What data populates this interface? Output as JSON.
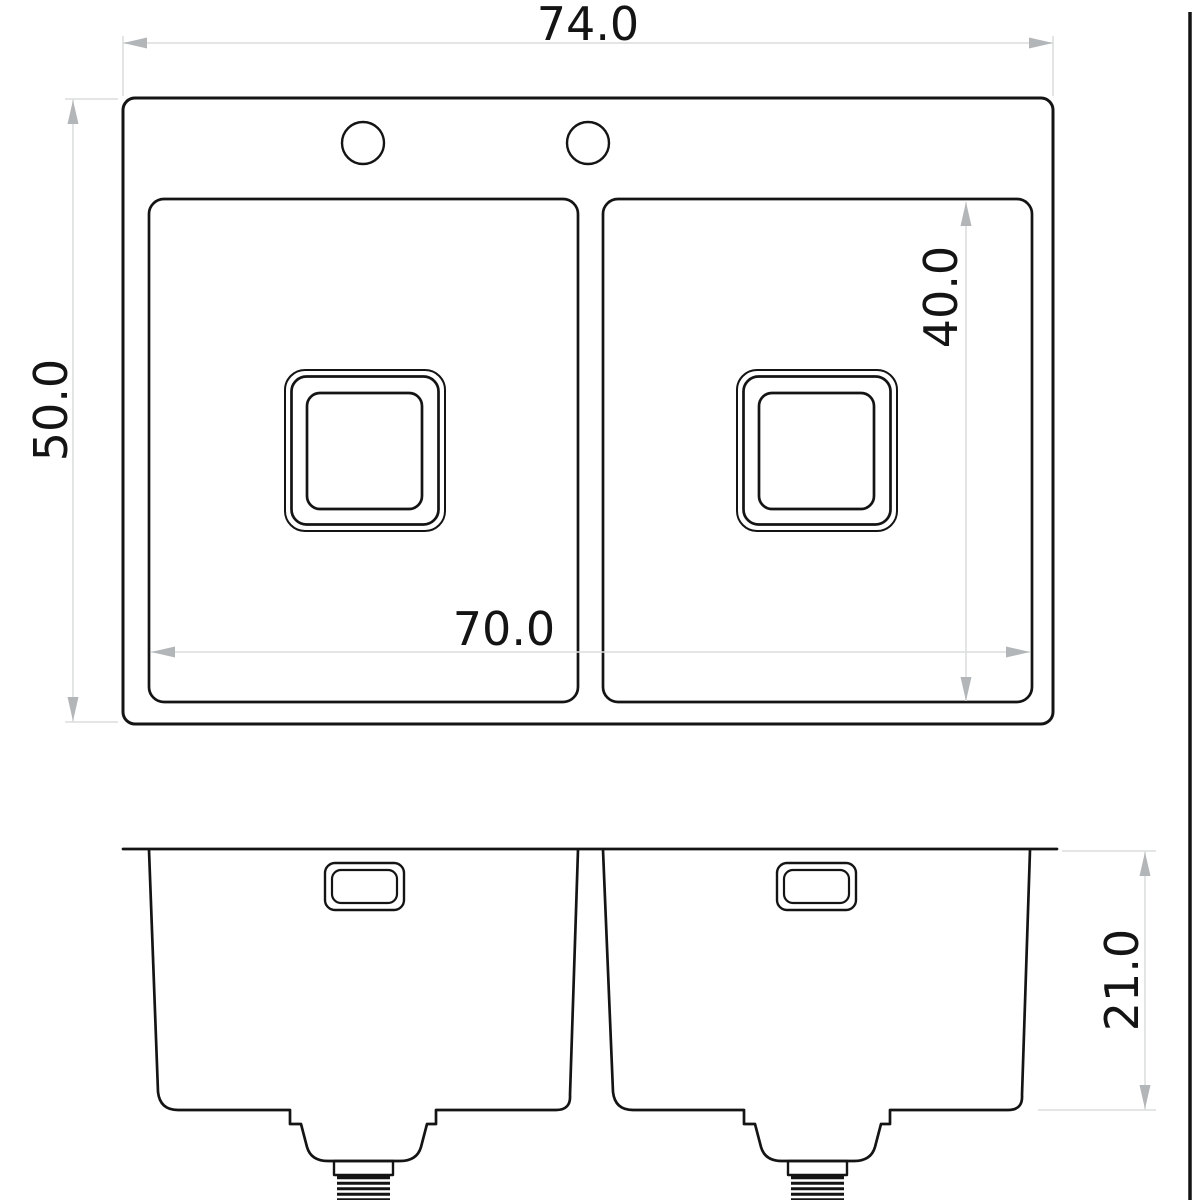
{
  "colors": {
    "line": "#141414",
    "dim": "#dcdddd",
    "arrow": "#b3b6b9",
    "text": "#141414",
    "bg": "#ffffff"
  },
  "drawing": {
    "type": "sink-dimension-drawing",
    "views": [
      "top-plan",
      "front-elevation"
    ]
  },
  "dims": {
    "overall_width": {
      "label": "74.0",
      "value": 74.0
    },
    "overall_depth": {
      "label": "50.0",
      "value": 50.0
    },
    "bowl_inner_depth": {
      "label": "40.0",
      "value": 40.0
    },
    "bowls_span_width": {
      "label": "70.0",
      "value": 70.0
    },
    "bowl_height": {
      "label": "21.0",
      "value": 21.0
    }
  }
}
